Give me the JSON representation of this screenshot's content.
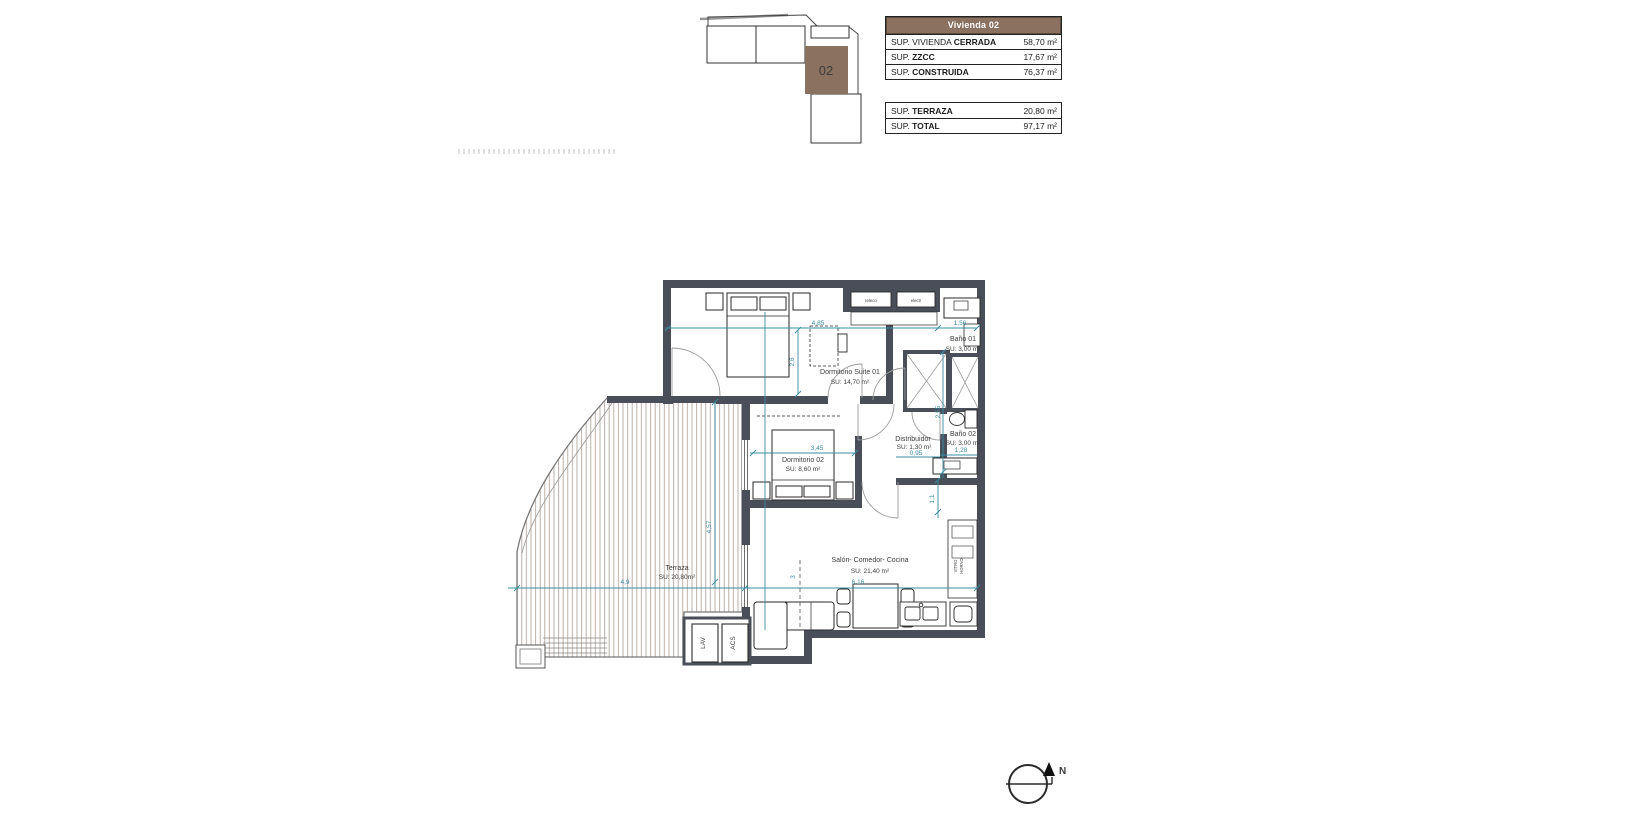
{
  "page": {
    "background": "#ffffff"
  },
  "key_plan": {
    "unit": "02",
    "unit_color": "#8a7160"
  },
  "summary_table": {
    "header": "Vivienda 02",
    "header_bg": "#8a7160",
    "main_rows": [
      {
        "prefix": "SUP. VIVIENDA ",
        "bold": "CERRADA",
        "value": "58,70 m²"
      },
      {
        "prefix": "SUP. ",
        "bold": "ZZCC",
        "value": "17,67 m²"
      },
      {
        "prefix": "SUP. ",
        "bold": "CONSTRUIDA",
        "value": "76,37 m²"
      }
    ],
    "total_rows": [
      {
        "prefix": "SUP. ",
        "bold": "TERRAZA",
        "value": "20,80 m²"
      },
      {
        "prefix": "SUP. ",
        "bold": "TOTAL",
        "value": "97,17 m²"
      }
    ]
  },
  "floor_plan": {
    "rooms": {
      "suite": {
        "name": "Dormitorio Suite 01",
        "area": "SU: 14,70 m²"
      },
      "bano1": {
        "name": "Baño 01",
        "area": "SU: 3,00 m²"
      },
      "distribuidor": {
        "name": "Distribuidor",
        "area": "SU: 1,30 m²"
      },
      "bano2": {
        "name": "Baño 02",
        "area": "SU: 3,00 m²"
      },
      "dorm2": {
        "name": "Dormitorio 02",
        "area": "SU: 8,60 m²"
      },
      "salon": {
        "name": "Salón- Comedor- Cocina",
        "area": "SU: 21,40 m²"
      },
      "terraza": {
        "name": "Terraza",
        "area": "SU: 20,80m²"
      }
    },
    "dims": {
      "suite_w": "4,85",
      "bano1_w": "1,56",
      "suite_h": "2,6",
      "banos_h": "2,55",
      "dorm2_w": "3,45",
      "distrib_w": "0,95",
      "bano2_w": "1,28",
      "kitchen_h": "1,1",
      "salon_h": "3",
      "salon_w": "6,16",
      "terraza_w": "4,9",
      "terraza_h": "4,57"
    },
    "fixtures": {
      "teleco": "teleco",
      "electr": "electr",
      "lav": "LAV",
      "acs": "ACS",
      "vitro": "VITRO",
      "horno": "HORNO"
    },
    "colors": {
      "wall": "#4a4e58",
      "dimension": "#3a8ca1"
    }
  },
  "north": {
    "label": "N"
  }
}
